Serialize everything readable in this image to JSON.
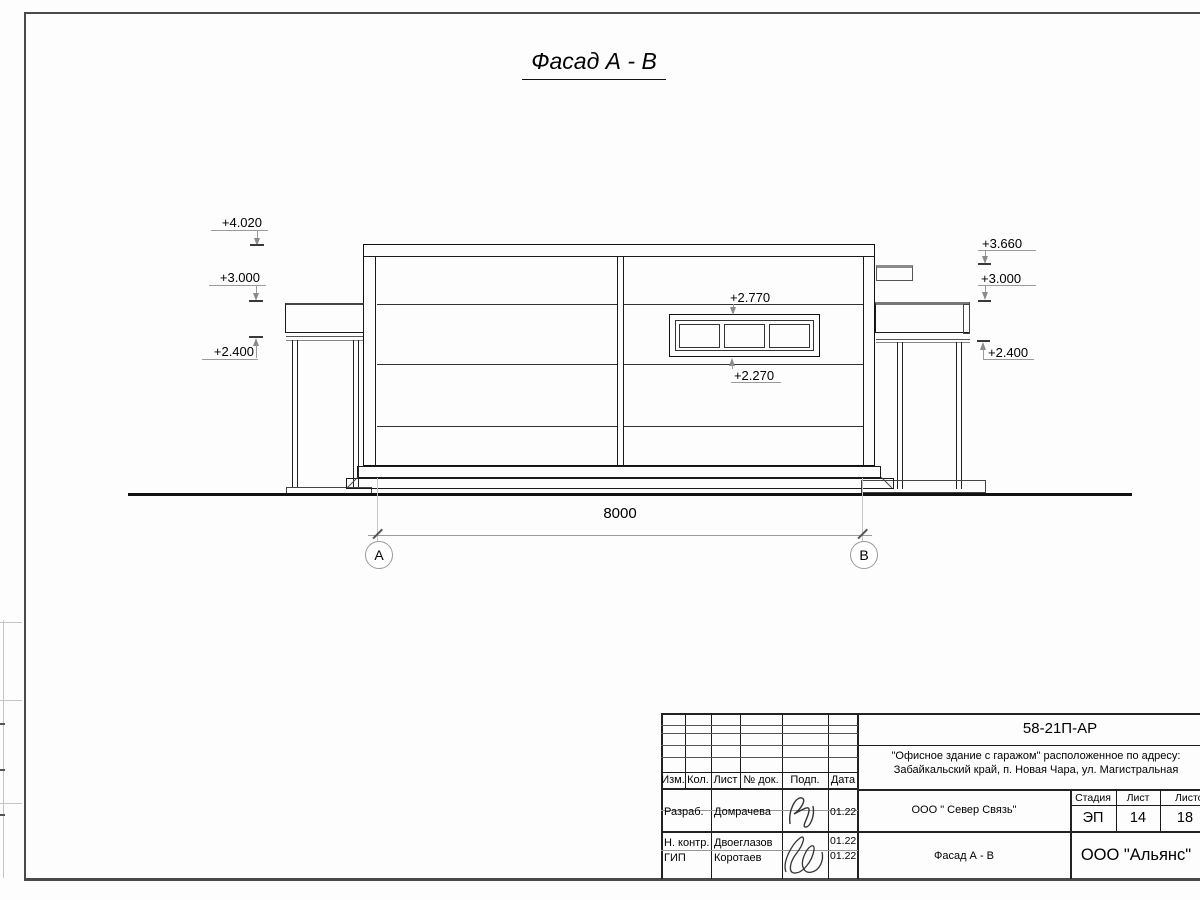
{
  "sheet": {
    "title": "Фасад А - В"
  },
  "elevation": {
    "marks_left": [
      "+4.020",
      "+3.000",
      "+2.400"
    ],
    "marks_right": [
      "+3.660",
      "+3.000",
      "+2.400"
    ],
    "mark_window_top": "+2.770",
    "mark_window_bottom": "+2.270",
    "span_dim": "8000",
    "axis_left": "А",
    "axis_right": "В"
  },
  "title_block": {
    "doc_number": "58-21П-АР",
    "project_line1": "\"Офисное здание с гаражом\" расположенное по адресу:",
    "project_line2": "Забайкальский край, п. Новая Чара, ул. Магистральная",
    "organization": "ООО \" Север Связь\"",
    "drawing_name": "Фасад А - В",
    "company": "ООО \"Альянс\"",
    "stage_label": "Стадия",
    "stage_value": "ЭП",
    "sheet_label": "Лист",
    "sheet_value": "14",
    "sheets_label": "Листов",
    "sheets_value": "18",
    "header": {
      "izm": "Изм.",
      "kol": "Кол.",
      "list": "Лист",
      "doc": "№ док.",
      "podp": "Подп.",
      "data": "Дата"
    },
    "rows": [
      {
        "role": "Разраб.",
        "name": "Домрачева",
        "date": "01.22"
      },
      {
        "role": "Н. контр.",
        "name": "Двоеглазов",
        "date": "01.22"
      },
      {
        "role": "ГИП",
        "name": "Коротаев",
        "date": "01.22"
      }
    ]
  }
}
